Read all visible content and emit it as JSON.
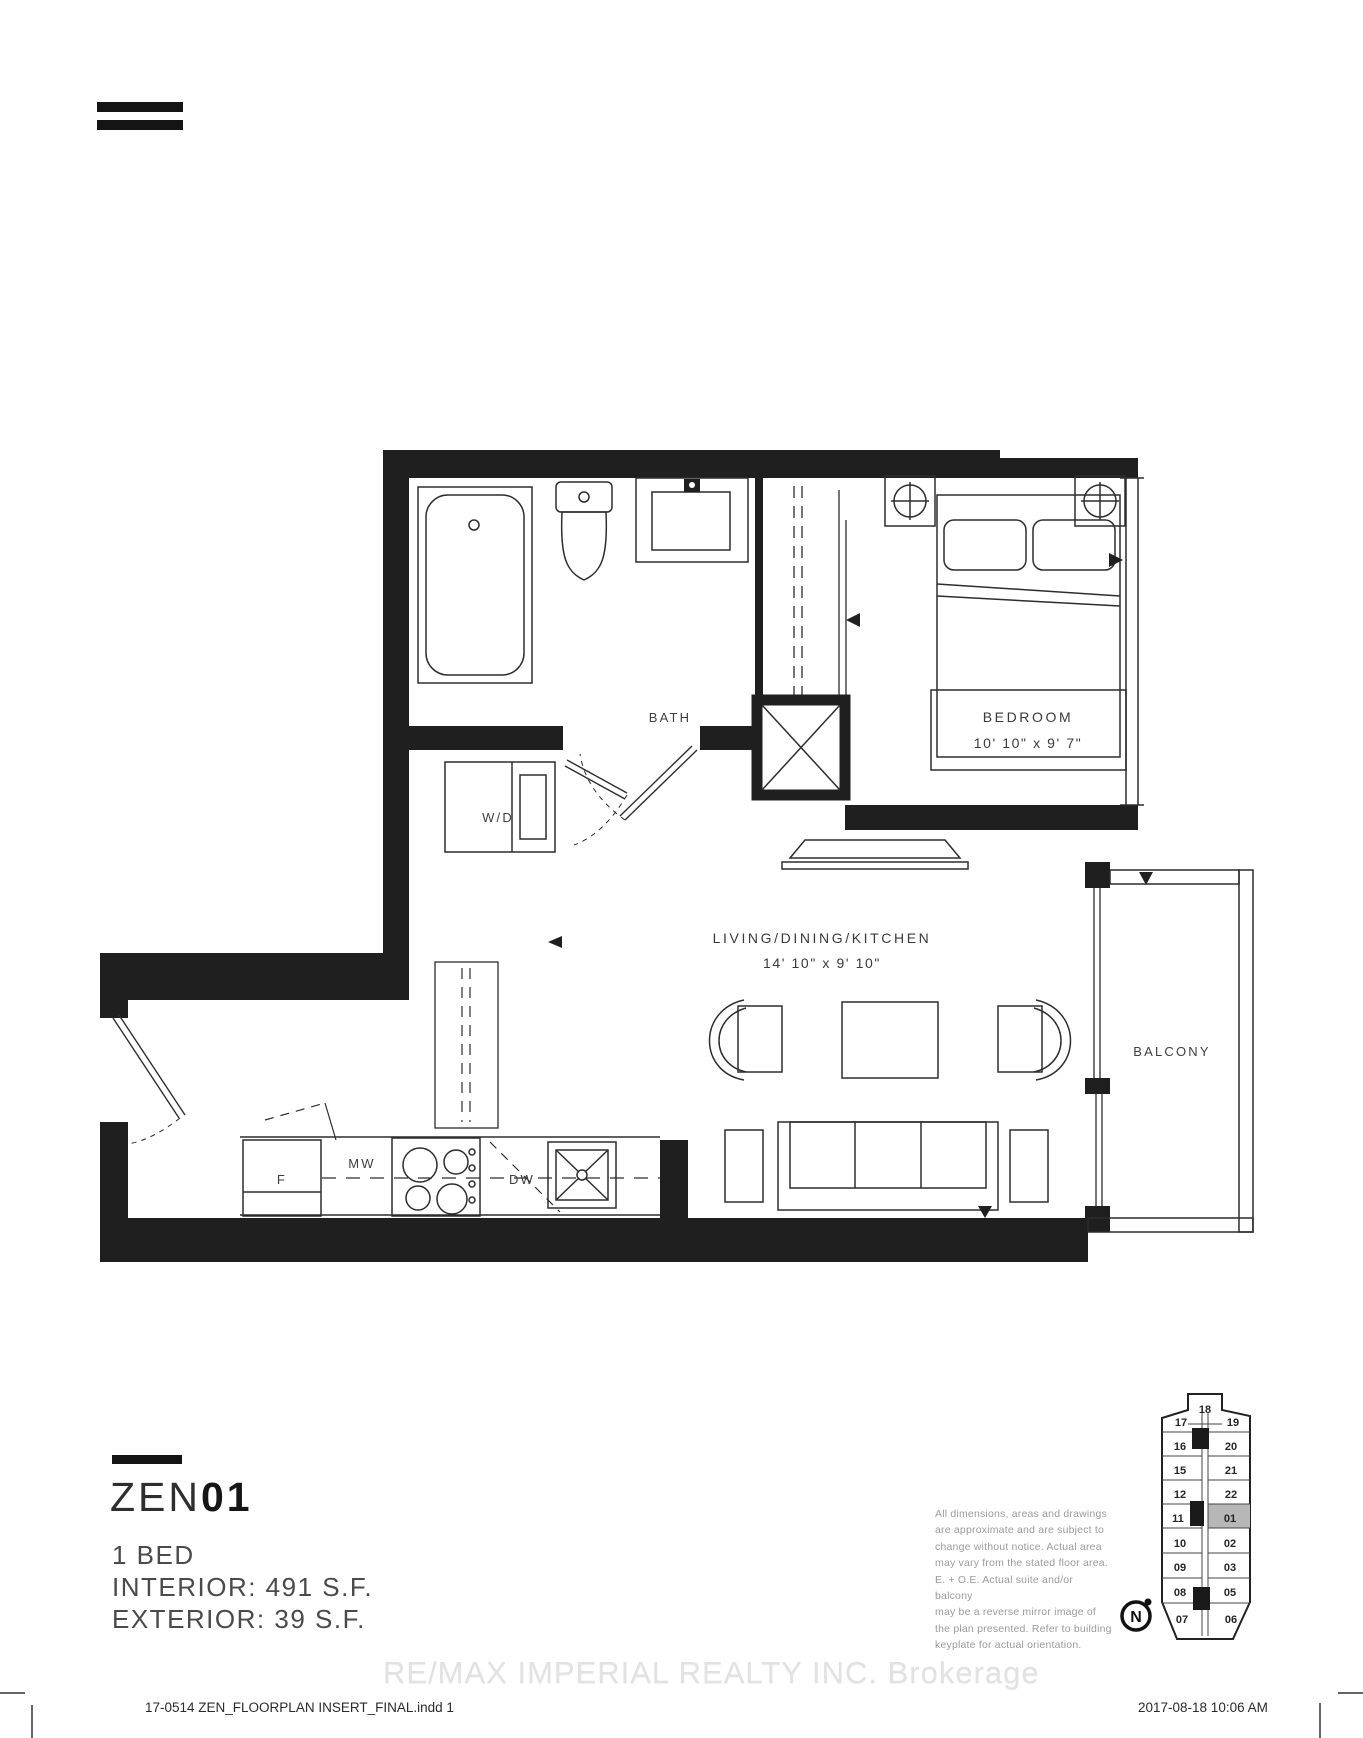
{
  "plan": {
    "labels": {
      "bath": "BATH",
      "washer_dryer": "W/D",
      "bedroom": "BEDROOM",
      "bedroom_dims": "10' 10\" x 9' 7\"",
      "living": "LIVING/DINING/KITCHEN",
      "living_dims": "14' 10\" x 9' 10\"",
      "balcony": "BALCONY",
      "fridge": "F",
      "microwave": "MW",
      "dishwasher": "DW"
    }
  },
  "unit_info": {
    "name_prefix": "ZEN",
    "name_number": "01",
    "bed_type": "1 BED",
    "interior": "INTERIOR: 491 S.F.",
    "exterior": "EXTERIOR: 39 S.F."
  },
  "disclaimer": {
    "text": "All dimensions, areas and drawings\nare approximate and are subject to\nchange without notice. Actual area\nmay vary from the stated floor area.\nE. + O.E. Actual suite and/or balcony\nmay be a reverse mirror image of\nthe plan presented. Refer to building\nkeyplate for actual orientation."
  },
  "keyplate": {
    "units": [
      {
        "label": "18"
      },
      {
        "label": "17"
      },
      {
        "label": "19"
      },
      {
        "label": "16"
      },
      {
        "label": "20"
      },
      {
        "label": "15"
      },
      {
        "label": "21"
      },
      {
        "label": "12"
      },
      {
        "label": "22"
      },
      {
        "label": "11"
      },
      {
        "label": "01"
      },
      {
        "label": "10"
      },
      {
        "label": "02"
      },
      {
        "label": "09"
      },
      {
        "label": "03"
      },
      {
        "label": "08"
      },
      {
        "label": "05"
      },
      {
        "label": "07"
      },
      {
        "label": "06"
      }
    ],
    "highlighted_unit": "01",
    "highlight_color": "#b7b7b7",
    "north_label": "N"
  },
  "watermark": {
    "text": "RE/MAX IMPERIAL REALTY INC.  Brokerage"
  },
  "footer": {
    "left": "17-0514 ZEN_FLOORPLAN INSERT_FINAL.indd   1",
    "right": "2017-08-18   10:06 AM"
  }
}
